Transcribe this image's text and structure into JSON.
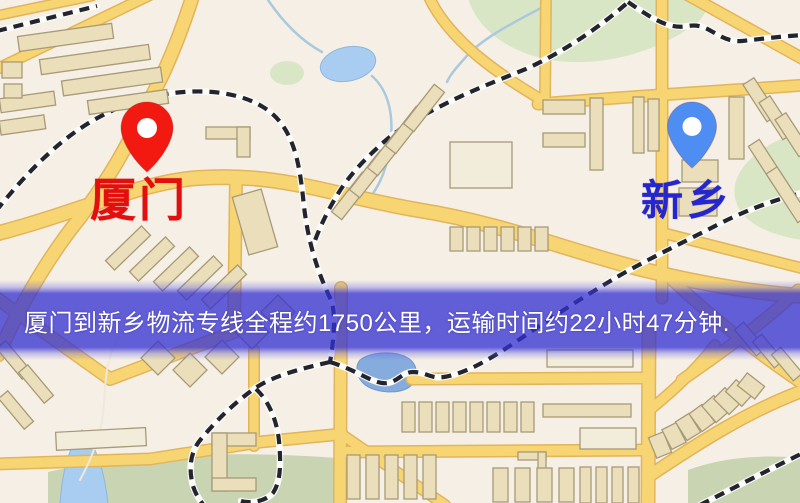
{
  "page": {
    "type": "logistics-route-map"
  },
  "map": {
    "markers": [
      {
        "id": "origin",
        "label": "厦门",
        "label_color": "#e30f0f",
        "pin_color": "#f21a10"
      },
      {
        "id": "destination",
        "label": "新乡",
        "label_color": "#2626cd",
        "pin_color": "#4e8df2"
      }
    ],
    "banner": {
      "text": "厦门到新乡物流专线全程约1750公里，运输时间约22小时47分钟.",
      "distance_km": "1750",
      "duration": "22小时47分钟",
      "bg_color": "#3430d2",
      "text_color": "#ffffff"
    },
    "legend_colors": {
      "background": "#f6efe5",
      "road": "#f7d573",
      "building": "#eadfba",
      "green_area": "#d9e6c6",
      "water": "#a9cdf0",
      "railway": "#23242e"
    }
  }
}
